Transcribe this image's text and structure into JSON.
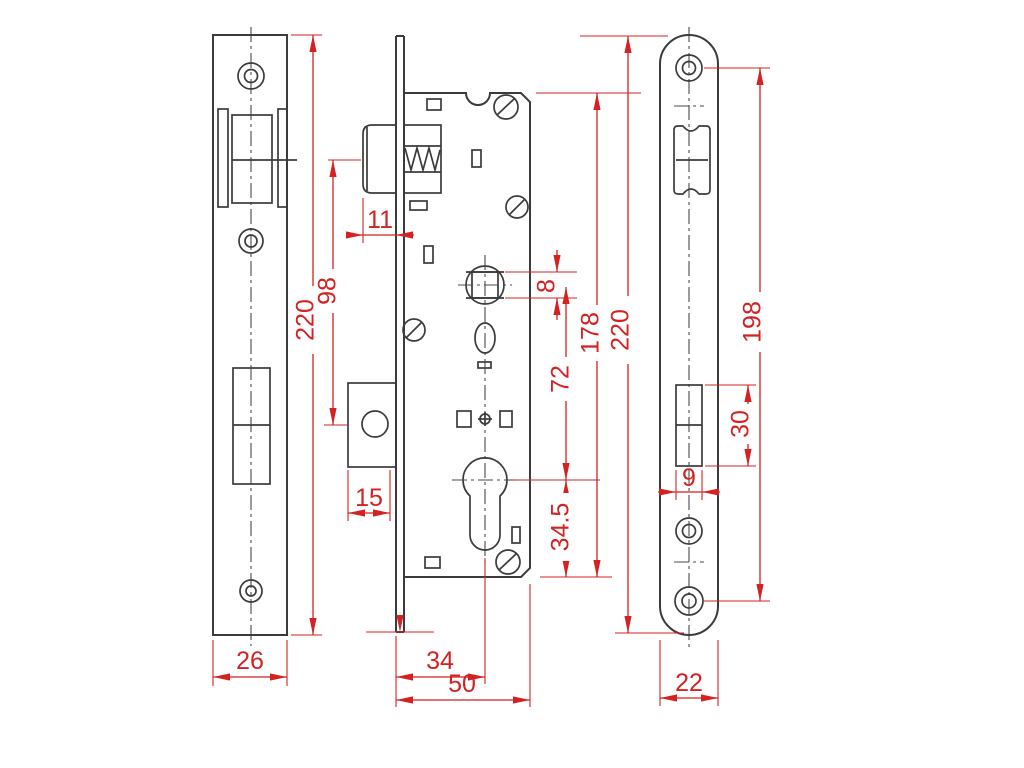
{
  "drawing": {
    "type": "technical-drawing",
    "subject": "mortise door lock with euro cylinder - three orthographic views with dimensions (mm)",
    "colors": {
      "outline": "#3b3b3b",
      "dimension": "#d42121",
      "background": "#ffffff"
    },
    "views": {
      "strike_plate": {
        "dims": {
          "width": "26",
          "height": "220"
        }
      },
      "lock_body": {
        "dims": {
          "latch_protrusion": "11",
          "latch_to_deadbolt": "98",
          "deadbolt_throw": "15",
          "backset": "34",
          "depth": "50",
          "spindle_square": "8",
          "spindle_to_cylinder": "72",
          "case_height": "178",
          "cylinder_to_bottom": "34.5"
        }
      },
      "faceplate": {
        "dims": {
          "height": "220",
          "screw_centers": "198",
          "bolt_cutout_height": "30",
          "bolt_cutout_width": "9",
          "width": "22"
        }
      }
    }
  }
}
